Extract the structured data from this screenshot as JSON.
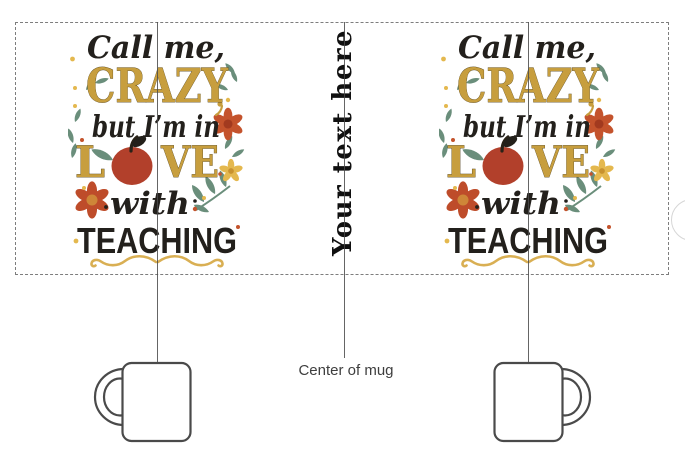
{
  "artboard": {
    "background": "#ffffff"
  },
  "design": {
    "line1": "Call me,",
    "line2": "CRAZY",
    "line3": "but I’m in",
    "line4_left": "L",
    "line4_right": "VE",
    "line5": "with",
    "line6": "TEACHING"
  },
  "center_placeholder": {
    "text": "Your text here"
  },
  "labels": {
    "center_of_mug": "Center of mug"
  },
  "colors": {
    "gold": "#C79E3E",
    "ink": "#23201C",
    "leaf_teal": "#6A8E7B",
    "flower_red": "#C4532C",
    "apple_red": "#B2402B",
    "accent_yellow": "#E4B84E",
    "flourish_gold": "#D9AF53",
    "guide_line": "#4A4A4A",
    "print_area_border": "#7D7D7D",
    "mug_outline": "#4A4A4A"
  },
  "icons": {
    "apple": "apple-icon",
    "leaf": "leaf-icon",
    "leaf_spray": "leaf-spray-icon",
    "flower": "flower-icon",
    "small_flower": "small-flower-icon",
    "flourish": "flourish-icon",
    "dots": "dot-accents-icon"
  }
}
